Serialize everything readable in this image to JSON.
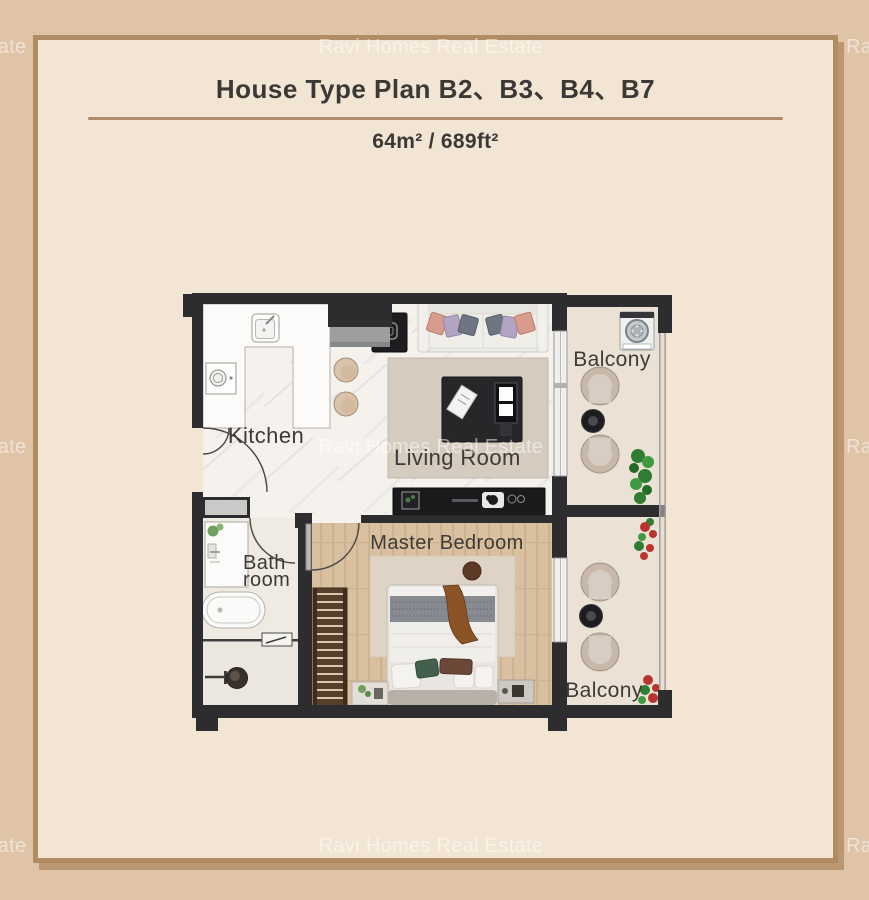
{
  "watermark": {
    "text": "Ravi Homes Real Estate"
  },
  "header": {
    "title": "House Type Plan B2、B3、B4、B7",
    "area": "64m² / 689ft²"
  },
  "rooms": {
    "kitchen": "Kitchen",
    "living_room": "Living Room",
    "master_bedroom": "Master Bedroom",
    "bathroom_line1": "Bath",
    "bathroom_line2": "room",
    "balcony_top": "Balcony",
    "balcony_bottom": "Balcony"
  },
  "colors": {
    "background": "#e0c4a8",
    "panel_background": "#f3e5d3",
    "panel_border": "#b18c63",
    "divider": "#b08c68",
    "title_text": "#3b3835",
    "label_text": "#3d3a37",
    "wall": "#2d2d2f",
    "wood_floor": "#d8c0a0",
    "marble_floor": "#f5f2ed",
    "balcony_floor": "#ebe2d5",
    "watermark": "rgba(255,255,255,0.52)"
  }
}
